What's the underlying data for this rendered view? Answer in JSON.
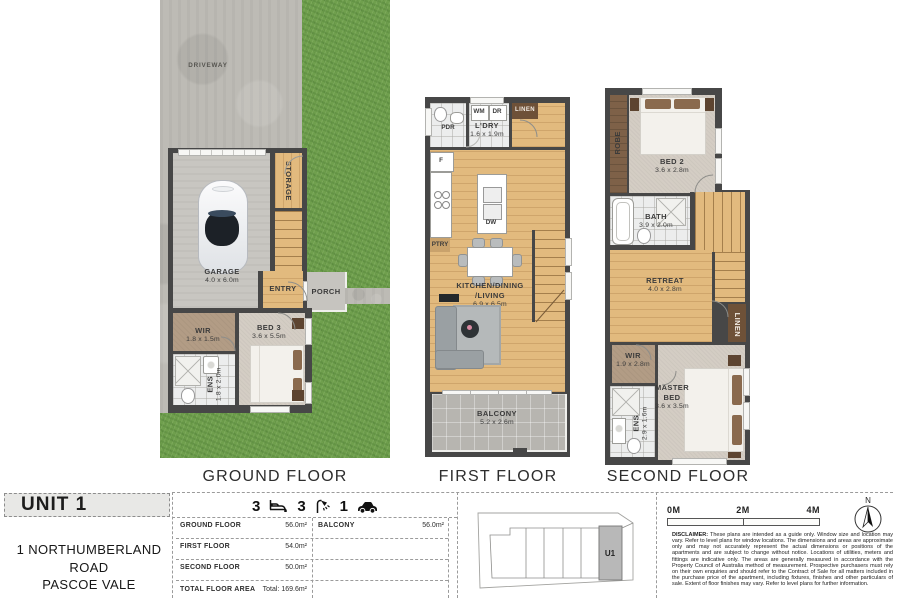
{
  "titles": {
    "ground": "GROUND FLOOR",
    "first": "FIRST FLOOR",
    "second": "SECOND FLOOR"
  },
  "ground": {
    "driveway": "DRIVEWAY",
    "storage": "STORAGE",
    "garage_name": "GARAGE",
    "garage_dim": "4.0 x 6.0m",
    "entry": "ENTRY",
    "porch": "PORCH",
    "wir_name": "WIR",
    "wir_dim": "1.8 x 1.5m",
    "bed3_name": "BED 3",
    "bed3_dim": "3.6 x 5.5m",
    "ens_name": "ENS",
    "ens_dim": "1.8 x 2.0m"
  },
  "first": {
    "pdr": "PDR",
    "wm": "WM",
    "dr": "DR",
    "linen": "LINEN",
    "ldry_name": "L'DRY",
    "ldry_dim": "1.6 x 1.9m",
    "fridge": "F",
    "ptry": "PTRY",
    "dw": "DW",
    "kdl_line1": "KITCHEN/DINING",
    "kdl_line2": "/LIVING",
    "kdl_dim": "6.9 x 6.5m",
    "balcony_name": "BALCONY",
    "balcony_dim": "5.2 x 2.6m"
  },
  "second": {
    "robe": "ROBE",
    "bed2_name": "BED 2",
    "bed2_dim": "3.6 x 2.8m",
    "bath_name": "BATH",
    "bath_dim": "3.9 x 2.0m",
    "retreat_name": "RETREAT",
    "retreat_dim": "4.0 x 2.8m",
    "linen": "LINEN",
    "wir_name": "WIR",
    "wir_dim": "1.9 x 2.8m",
    "master_name": "MASTER BED",
    "master_dim": "3.6 x 3.5m",
    "ens_name": "ENS",
    "ens_dim": "2.9 x 1.6m"
  },
  "info": {
    "unit": "UNIT 1",
    "address_line1": "1 NORTHUMBERLAND ROAD",
    "address_line2": "PASCOE VALE",
    "stats": {
      "beds": "3",
      "baths": "3",
      "cars": "1",
      "icons": [
        "bed-icon",
        "shower-icon",
        "car-icon"
      ]
    },
    "areas": {
      "rows": [
        {
          "label": "GROUND FLOOR",
          "value": "56.0m²"
        },
        {
          "label": "FIRST FLOOR",
          "value": "54.0m²"
        },
        {
          "label": "SECOND FLOOR",
          "value": "50.0m²"
        }
      ],
      "balcony": {
        "label": "BALCONY",
        "value": "56.0m²"
      },
      "total_label": "TOTAL FLOOR AREA",
      "total_value": "Total: 169.6m²"
    },
    "sitemap_unit": "U1",
    "scale": {
      "t0": "0M",
      "t1": "2M",
      "t2": "4M"
    },
    "compass": "N",
    "disclaimer_title": "DISCLAIMER:",
    "disclaimer_text": " These plans are intended as a guide only. Window size and location may vary. Refer to level plans for window locations. The dimensions and areas are approximate only and may not accurately represent the actual dimensions or positions of the apartments and are subject to change without notice. Locations of utilities, meters and fittings are indicative only. The areas are generally measured in accordance with the Property Council of Australia method of measurement. Prospective purchasers must rely on their own enquiries and should refer to the Contract of Sale for all matters included in the purchase price of the apartment, including fixtures, finishes and other particulars of sale. Extent of floor finishes may vary. Refer to level plans for further information."
  },
  "colors": {
    "grass": "#6f9f4d",
    "wood": "#e2ba7e",
    "wall": "#474747",
    "carpet": "#d4cdc4",
    "highlight_unit": "#b8b8b8"
  }
}
